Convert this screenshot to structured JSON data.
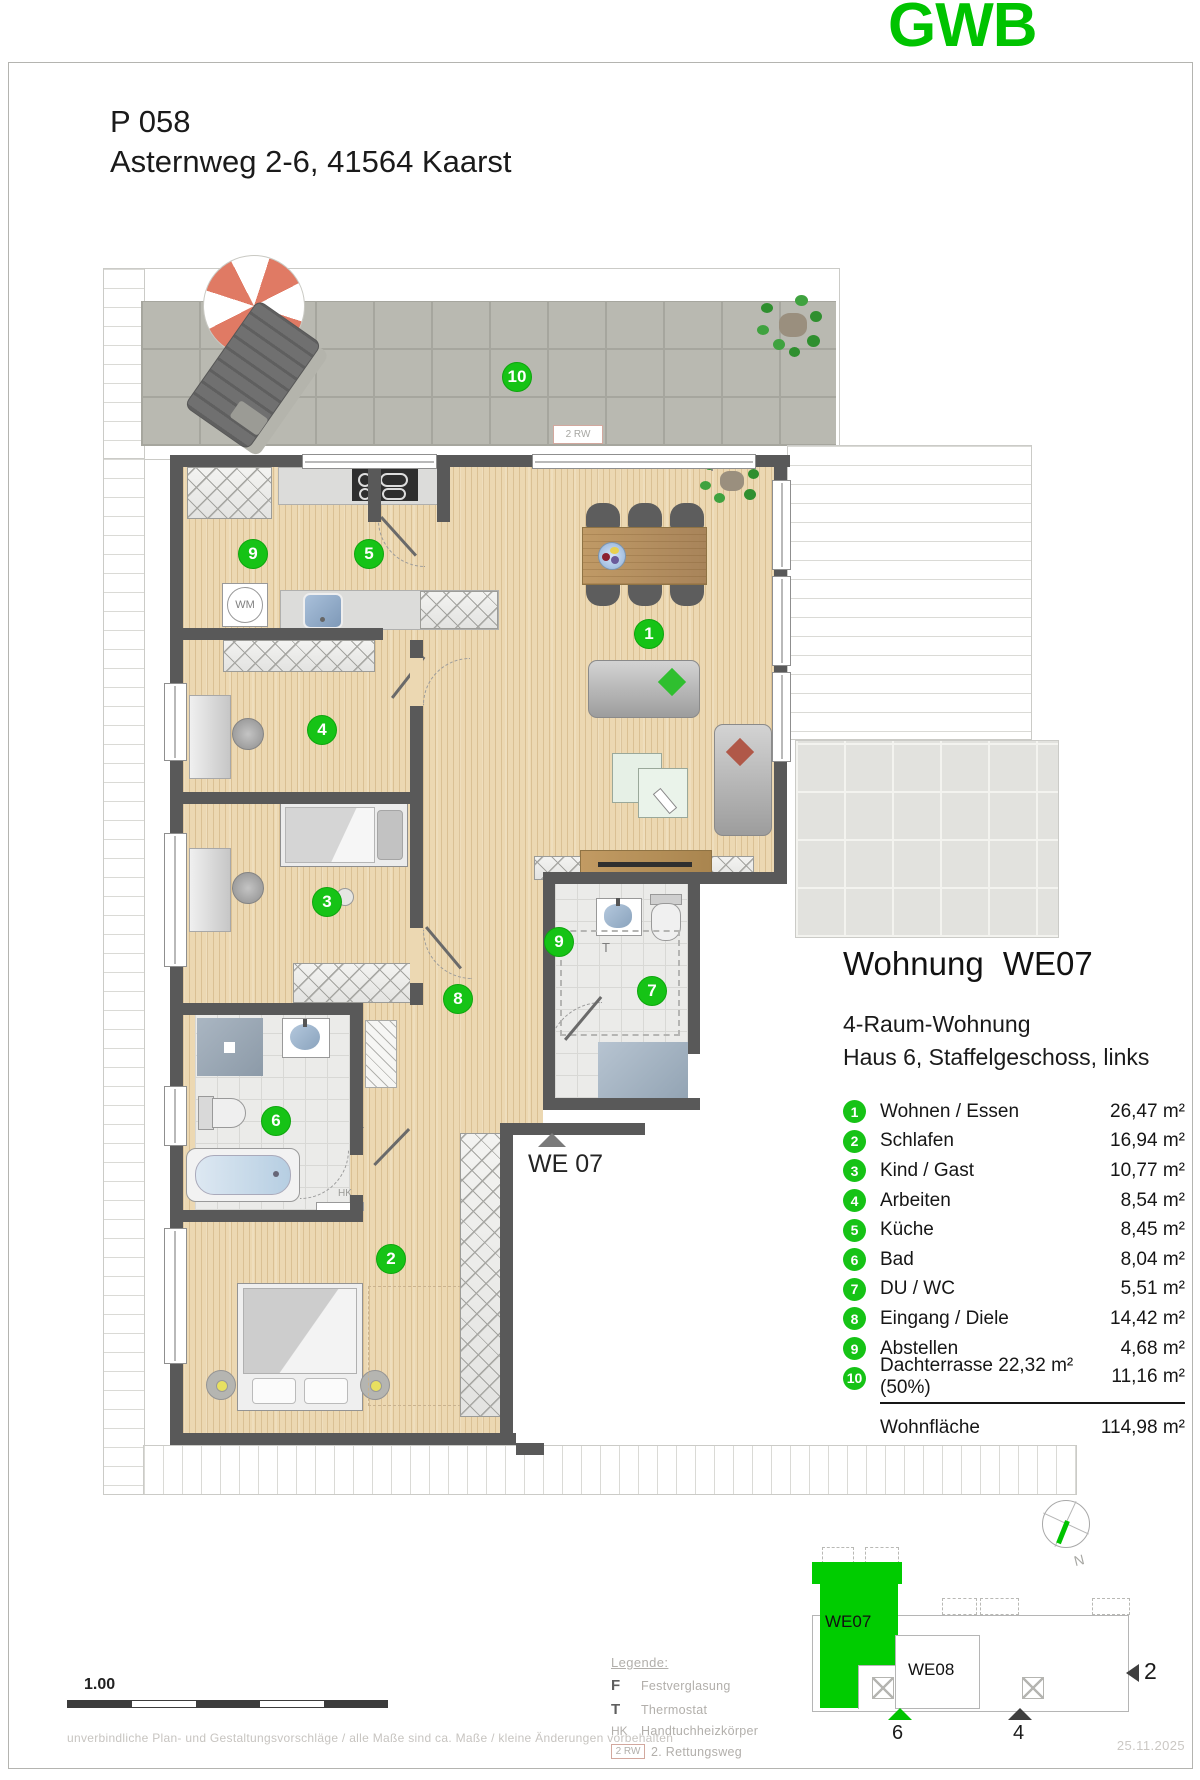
{
  "brand": {
    "logo_text": "GWB",
    "brand_green": "#00c300"
  },
  "header": {
    "project_code": "P 058",
    "address": "Asternweg 2-6, 41564 Kaarst"
  },
  "apartment_info": {
    "title": "Wohnung WE07",
    "type": "4-Raum-Wohnung",
    "location": "Haus 6, Staffelgeschoss, links",
    "rooms": [
      {
        "num": "1",
        "label": "Wohnen / Essen",
        "area": "26,47 m²"
      },
      {
        "num": "2",
        "label": "Schlafen",
        "area": "16,94 m²"
      },
      {
        "num": "3",
        "label": "Kind / Gast",
        "area": "10,77 m²"
      },
      {
        "num": "4",
        "label": "Arbeiten",
        "area": "8,54 m²"
      },
      {
        "num": "5",
        "label": "Küche",
        "area": "8,45 m²"
      },
      {
        "num": "6",
        "label": "Bad",
        "area": "8,04 m²"
      },
      {
        "num": "7",
        "label": "DU / WC",
        "area": "5,51 m²"
      },
      {
        "num": "8",
        "label": "Eingang / Diele",
        "area": "14,42 m²"
      },
      {
        "num": "9",
        "label": "Abstellen",
        "area": "4,68 m²"
      },
      {
        "num": "10",
        "label": "Dachterrasse 22,32 m² (50%)",
        "area": "11,16 m²"
      }
    ],
    "total_label": "Wohnfläche",
    "total_area": "114,98 m²"
  },
  "plan": {
    "unit_label": "WE 07",
    "markers": [
      "10",
      "9",
      "5",
      "1",
      "4",
      "3",
      "8",
      "9",
      "7",
      "6",
      "2"
    ],
    "labels": {
      "wm": "WM",
      "fixed_glazing": "F",
      "thermostat": "T",
      "towel_radiator": "HK",
      "escape_route": "2 RW"
    }
  },
  "legend": {
    "title": "Legende:",
    "items": [
      {
        "key": "F",
        "label": "Festverglasung"
      },
      {
        "key": "T",
        "label": "Thermostat"
      },
      {
        "key": "HK",
        "label": "Handtuchheizkörper"
      },
      {
        "key": "2 RW",
        "label": "2. Rettungsweg"
      }
    ]
  },
  "scale_bar": {
    "label": "1.00"
  },
  "disclaimer": "unverbindliche Plan- und Gestaltungsvorschläge / alle Maße sind ca. Maße / kleine Änderungen vorbehalten",
  "keyplan": {
    "highlight_unit": "WE07",
    "neighbor_unit": "WE08",
    "north": "N",
    "entrance_6": "6",
    "entrance_4": "4",
    "side_2": "2"
  },
  "plan_date": "25.11.2025"
}
